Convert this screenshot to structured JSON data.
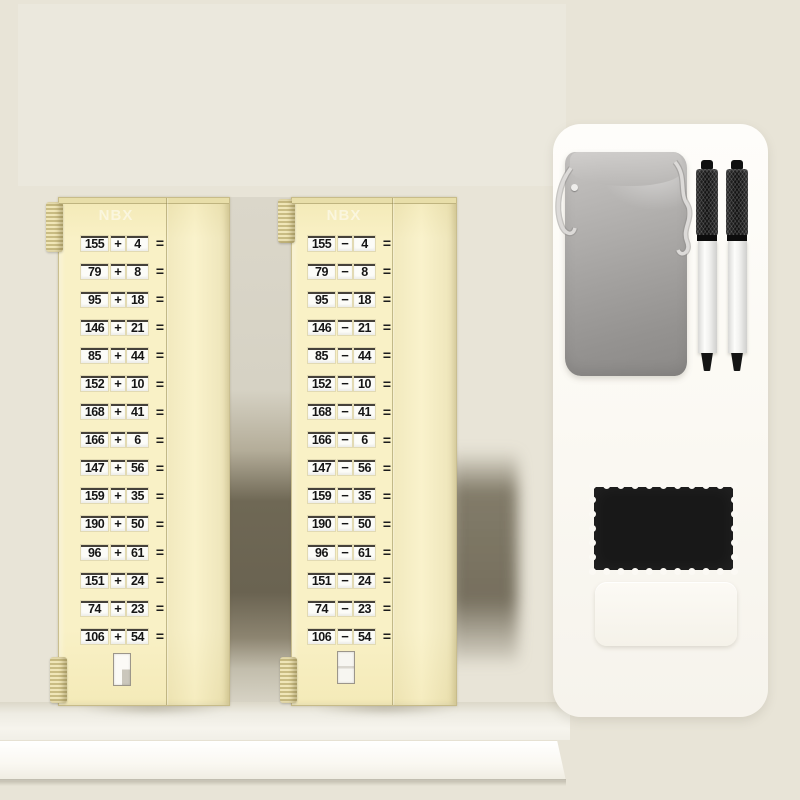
{
  "product": {
    "brand_logo": "NBX",
    "description": "children math practice slide boards with accessories"
  },
  "boards": [
    {
      "id": "addition-board",
      "logo": "NBX",
      "operator": "+",
      "equals": "=",
      "problems": [
        {
          "a": "155",
          "b": "4"
        },
        {
          "a": "79",
          "b": "8"
        },
        {
          "a": "95",
          "b": "18"
        },
        {
          "a": "146",
          "b": "21"
        },
        {
          "a": "85",
          "b": "44"
        },
        {
          "a": "152",
          "b": "10"
        },
        {
          "a": "168",
          "b": "41"
        },
        {
          "a": "166",
          "b": "6"
        },
        {
          "a": "147",
          "b": "56"
        },
        {
          "a": "159",
          "b": "35"
        },
        {
          "a": "190",
          "b": "50"
        },
        {
          "a": "96",
          "b": "61"
        },
        {
          "a": "151",
          "b": "24"
        },
        {
          "a": "74",
          "b": "23"
        },
        {
          "a": "106",
          "b": "54"
        }
      ]
    },
    {
      "id": "subtraction-board",
      "logo": "NBX",
      "operator": "−",
      "equals": "=",
      "problems": [
        {
          "a": "155",
          "b": "4"
        },
        {
          "a": "79",
          "b": "8"
        },
        {
          "a": "95",
          "b": "18"
        },
        {
          "a": "146",
          "b": "21"
        },
        {
          "a": "85",
          "b": "44"
        },
        {
          "a": "152",
          "b": "10"
        },
        {
          "a": "168",
          "b": "41"
        },
        {
          "a": "166",
          "b": "6"
        },
        {
          "a": "147",
          "b": "56"
        },
        {
          "a": "159",
          "b": "35"
        },
        {
          "a": "190",
          "b": "50"
        },
        {
          "a": "96",
          "b": "61"
        },
        {
          "a": "151",
          "b": "24"
        },
        {
          "a": "74",
          "b": "23"
        },
        {
          "a": "106",
          "b": "54"
        }
      ]
    }
  ],
  "accessories": {
    "pouch": "gray velvet drawstring pouch",
    "pens": "two dry-erase marker pens",
    "cloth": "black cleaning cloth",
    "eraser": "white eraser block"
  },
  "colors": {
    "background": "#e8e4d7",
    "board": "#f8f0c4",
    "panel": "#fcfaf5",
    "pouch": "#a8a6a4",
    "cloth": "#181818",
    "shadow": "#6f6855"
  }
}
